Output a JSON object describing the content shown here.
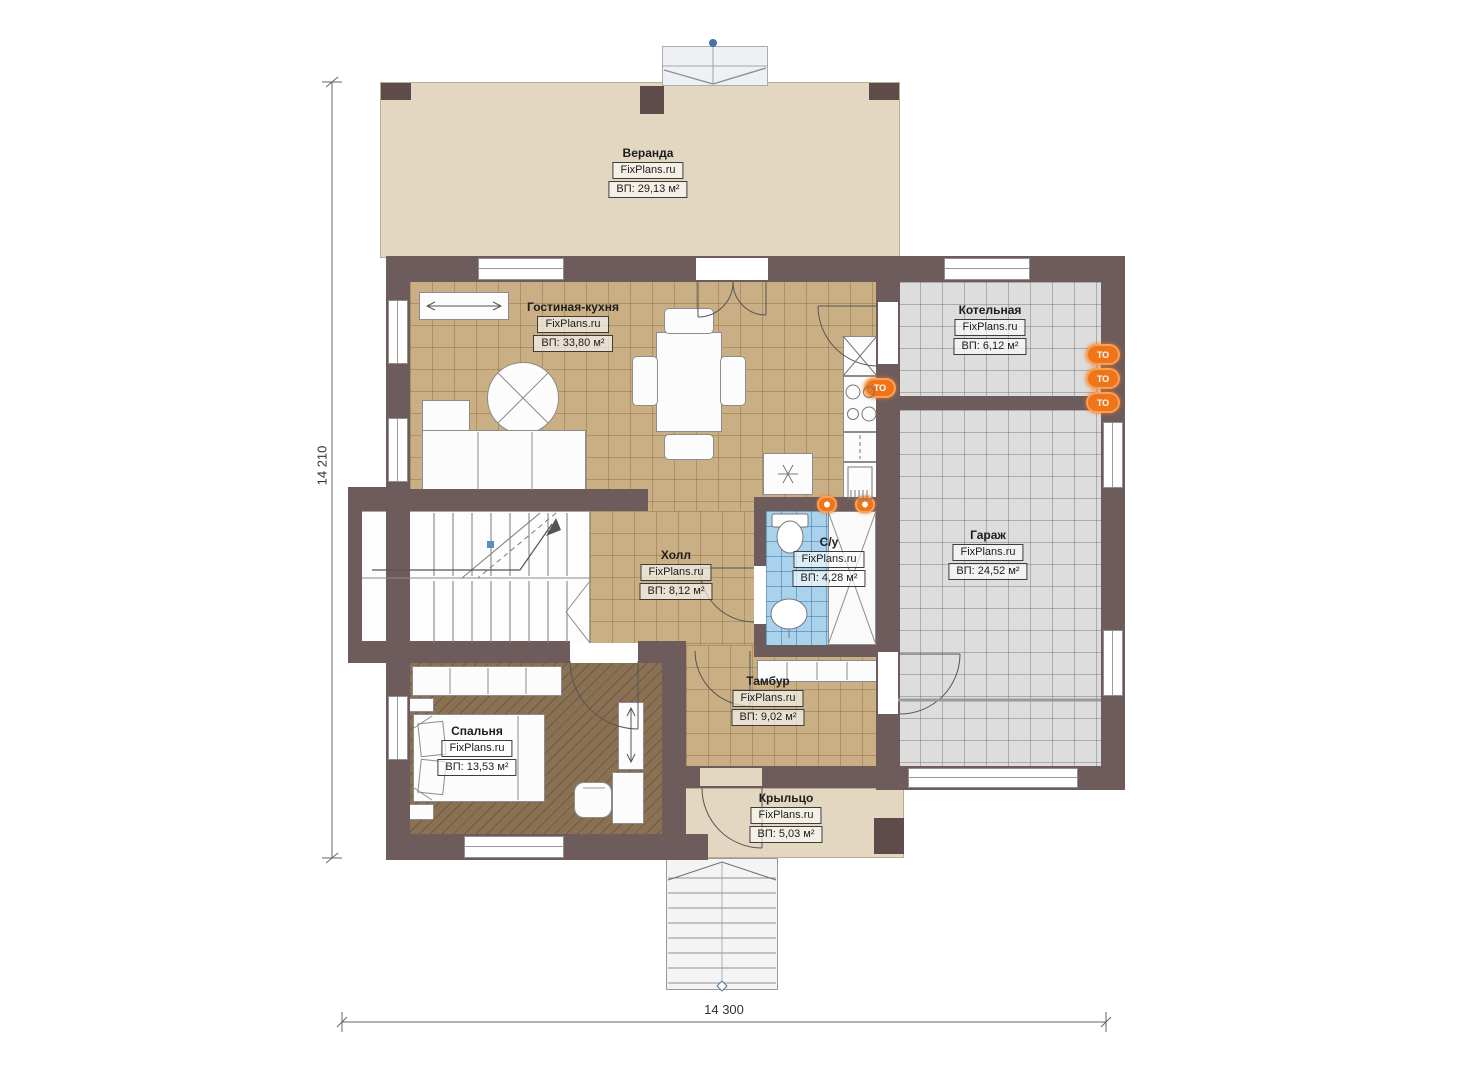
{
  "plan": {
    "brand": "FixPlans.ru",
    "dimensions": {
      "height_label": "14 210",
      "width_label": "14 300"
    },
    "rooms": [
      {
        "name": "Веранда",
        "brand": "FixPlans.ru",
        "area": "ВП: 29,13 м²"
      },
      {
        "name": "Гостиная-кухня",
        "brand": "FixPlans.ru",
        "area": "ВП: 33,80 м²"
      },
      {
        "name": "Котельная",
        "brand": "FixPlans.ru",
        "area": "ВП: 6,12 м²"
      },
      {
        "name": "Гараж",
        "brand": "FixPlans.ru",
        "area": "ВП: 24,52 м²"
      },
      {
        "name": "Холл",
        "brand": "FixPlans.ru",
        "area": "ВП: 8,12 м²"
      },
      {
        "name": "С/у",
        "brand": "FixPlans.ru",
        "area": "ВП: 4,28 м²"
      },
      {
        "name": "Тамбур",
        "brand": "FixPlans.ru",
        "area": "ВП: 9,02 м²"
      },
      {
        "name": "Спальня",
        "brand": "FixPlans.ru",
        "area": "ВП: 13,53 м²"
      },
      {
        "name": "Крыльцо",
        "brand": "FixPlans.ru",
        "area": "ВП: 5,03 м²"
      }
    ],
    "icons": {
      "heating_label": "ТО"
    },
    "colors": {
      "wall": "#6e5c5c",
      "wall_dark": "#5e4b4a",
      "tan": "#c9af83",
      "gray": "#dddddd",
      "blue": "#a9d2ec",
      "wood": "#8b7154",
      "beige": "#e3d7c2",
      "beige_border": "#bbac92",
      "accent": "#f07418",
      "accent_light": "#f9a05c"
    }
  }
}
